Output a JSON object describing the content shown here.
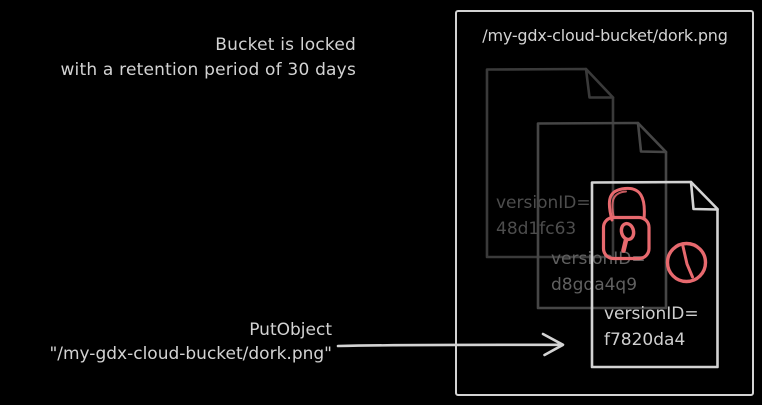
{
  "annotation": {
    "line1": "Bucket is locked",
    "line2": "with a retention period of 30 days"
  },
  "bucket": {
    "title": "/my-gdx-cloud-bucket/dork.png"
  },
  "versions": [
    {
      "label": "versionID=",
      "id": "48d1fc63",
      "layer": "back"
    },
    {
      "label": "versionID=",
      "id": "d8gda4q9",
      "layer": "middle"
    },
    {
      "label": "versionID=",
      "id": "f7820da4",
      "layer": "front"
    }
  ],
  "action": {
    "name": "PutObject",
    "target": "\"/my-gdx-cloud-bucket/dork.png\""
  },
  "icons": {
    "lock": "retention-lock",
    "clock": "retention-timer",
    "documents": "object-versions"
  },
  "colors": {
    "background": "#000000",
    "light": "#d3d3d3",
    "doc_back_stroke": "#3a3a3a",
    "doc_middle_stroke": "#464646",
    "text_back": "#4d4d4d",
    "text_middle": "#606060",
    "accent_red": "#e7696e"
  }
}
